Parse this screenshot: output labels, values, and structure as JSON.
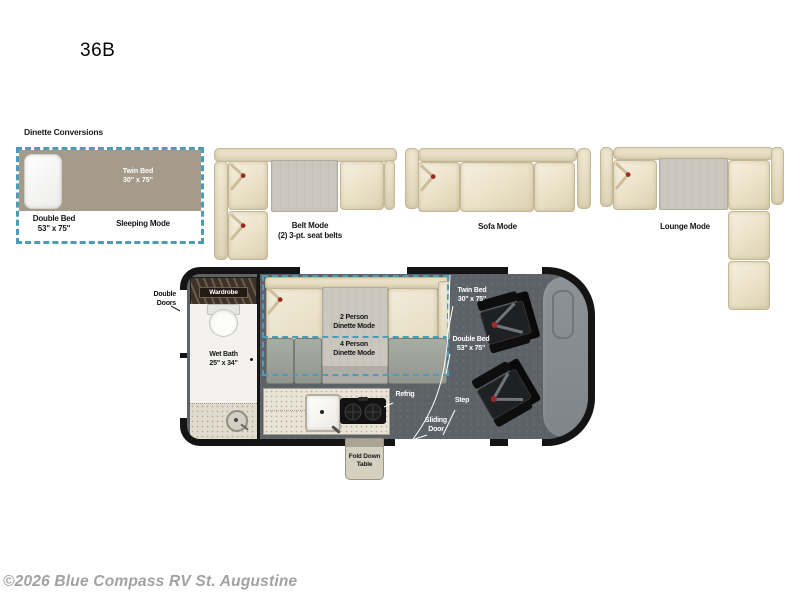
{
  "title": "36B",
  "section_label": "Dinette Conversions",
  "panels": {
    "sleeping": {
      "twin_bed_l1": "Twin Bed",
      "twin_bed_l2": "30\" x 75\"",
      "double_bed_l1": "Double Bed",
      "double_bed_l2": "53\" x 75\"",
      "mode": "Sleeping Mode"
    },
    "belt": {
      "mode": "Belt Mode",
      "note": "(2) 3-pt. seat belts"
    },
    "sofa": {
      "mode": "Sofa Mode"
    },
    "lounge": {
      "mode": "Lounge Mode"
    }
  },
  "floorplan": {
    "labels": {
      "double_doors": {
        "l1": "Double",
        "l2": "Doors"
      },
      "wardrobe": "Wardrobe",
      "wet_bath": {
        "l1": "Wet Bath",
        "l2": "25\" x 34\""
      },
      "dinette_2p": {
        "l1": "2 Person",
        "l2": "Dinette Mode"
      },
      "dinette_4p": {
        "l1": "4 Person",
        "l2": "Dinette Mode"
      },
      "twin_bed": {
        "l1": "Twin Bed",
        "l2": "30\" x 75\""
      },
      "double_bed": {
        "l1": "Double Bed",
        "l2": "53\" x 75\""
      },
      "refrig": "Refrig",
      "step": "Step",
      "sliding_door": {
        "l1": "Sliding",
        "l2": "Door"
      },
      "fold_down_table": {
        "l1": "Fold Down",
        "l2": "Table"
      }
    }
  },
  "copyright": "©2026 Blue Compass RV St. Augustine",
  "colors": {
    "accent_dash": "#4a9db9",
    "bed_tan": "#a49b8b",
    "sofa_cream": "#ece3cb",
    "table_gray": "#cbc7bf",
    "floor_gray": "#5c6268",
    "hood_gray": "#878e94",
    "belt_buckle_red": "#9c2a22",
    "copyright_gray": "#a2a2a2"
  }
}
